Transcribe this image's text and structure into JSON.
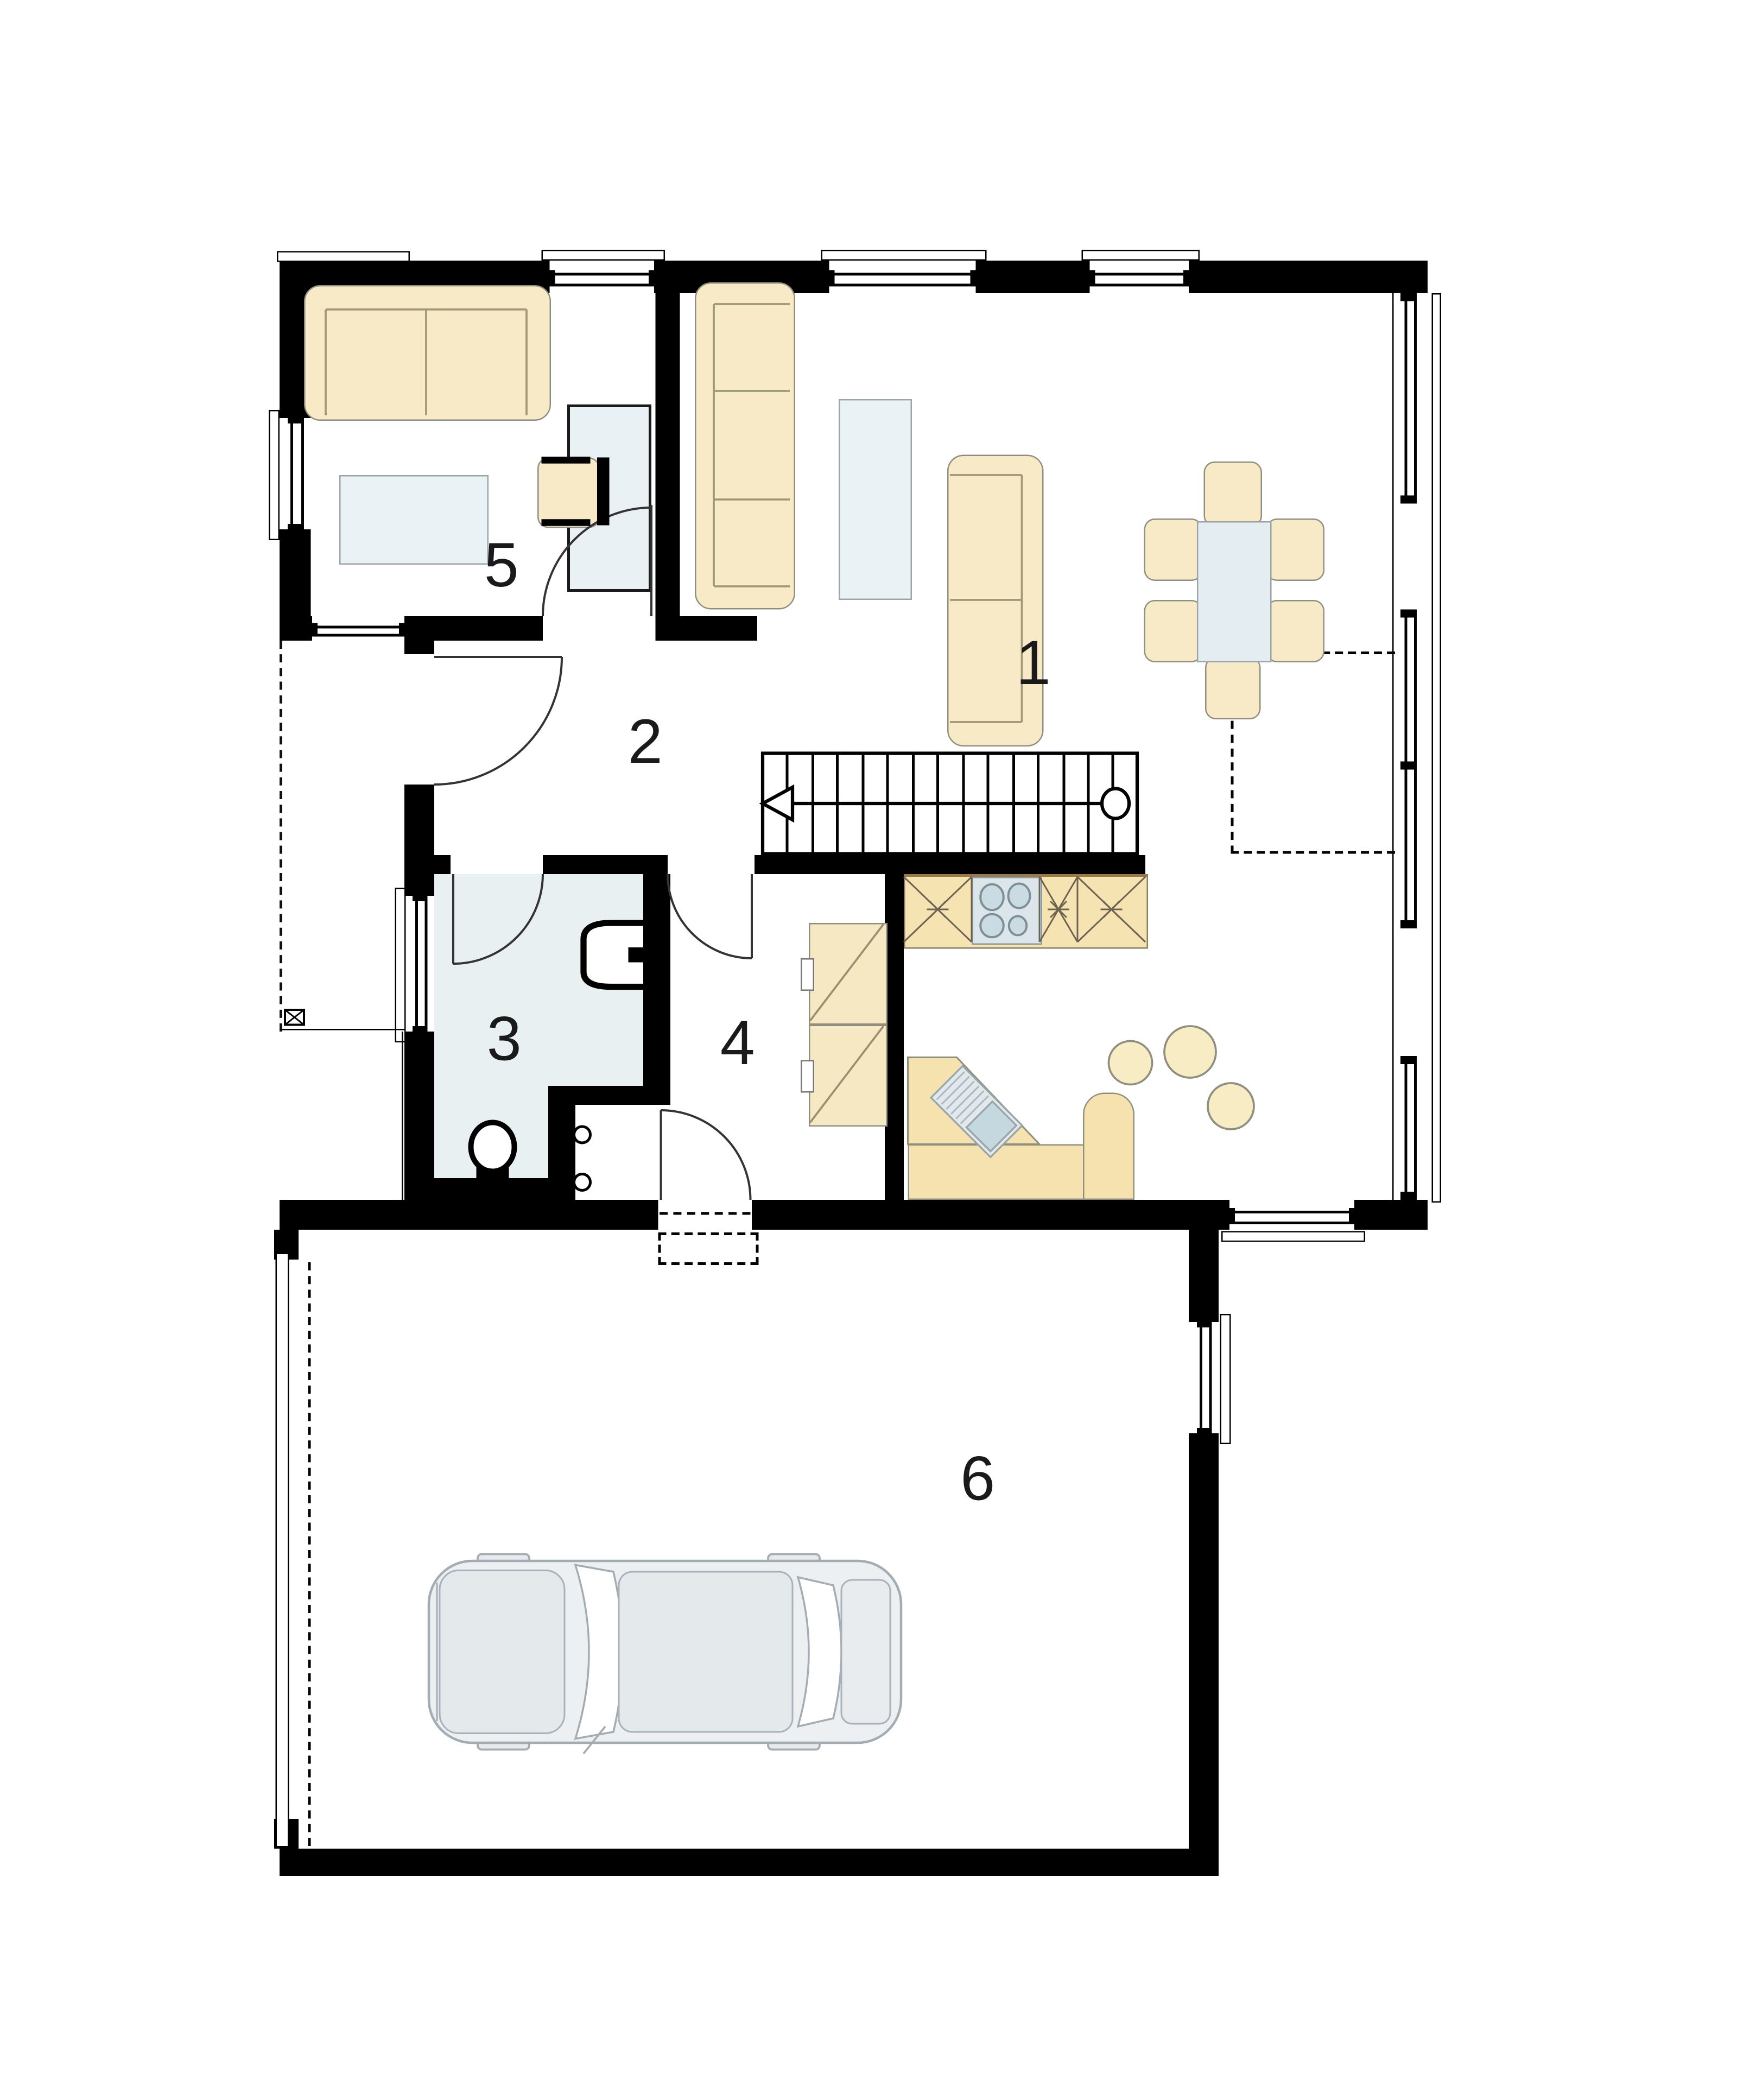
{
  "plan": {
    "type": "residential ground-floor plan with garage",
    "rooms": [
      {
        "number": "1",
        "role": "living-dining room"
      },
      {
        "number": "2",
        "role": "hallway"
      },
      {
        "number": "3",
        "role": "bathroom"
      },
      {
        "number": "4",
        "role": "entry / utility room"
      },
      {
        "number": "5",
        "role": "study"
      },
      {
        "number": "6",
        "role": "garage"
      }
    ]
  },
  "colors": {
    "wall": "#000000",
    "furniture_cream": "#F8EAC6",
    "kitchen_cream": "#F6E3B2",
    "table_blue": "#EAF2F5",
    "bath_floor": "#E9F0F1",
    "cooktop": "#DCE6EA",
    "sink_basin": "#C6D8DF",
    "car_body": "#EDF0F2"
  }
}
